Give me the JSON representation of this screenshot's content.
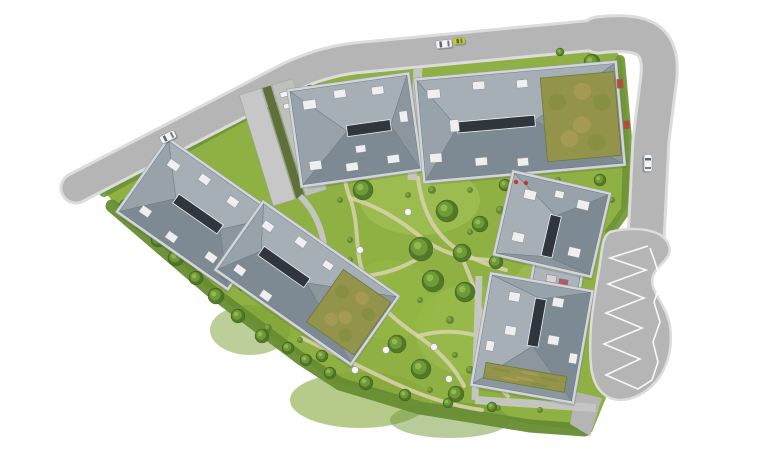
{
  "meta": {
    "label": "Aerial architectural site plan rendering of a residential complex with six buildings, gardens, perimeter roads and cars"
  },
  "palette": {
    "background": "#ffffff",
    "road": "#b5b5b5",
    "curb": "#dcdcdc",
    "marking": "#ffffff",
    "grass": "#8fb043",
    "grass_dark": "#6d9435",
    "grass_darker": "#678c31",
    "grass_light": "#a9c75a",
    "sand_path": "#d9d2ae",
    "gray_path": "#c6c6c6",
    "tree_dark": "#4e7527",
    "tree_mid": "#6f9a35",
    "tree_light": "#93b84f",
    "bush": "#5d8230",
    "bush_inner": "#7fa33e",
    "wall": "#d3d6d9",
    "wall_edge": "#969ca2",
    "roof_north": "#a7afb6",
    "roof_south": "#7e8a93",
    "roof_west": "#98a2aa",
    "roof_east": "#8b969f",
    "roof_edge": "#6e7a84",
    "ridge": "#2f363d",
    "ridge_frame": "#eeeeee",
    "skylight": "#efefef",
    "skylight_edge": "#8a9096",
    "green_roof": "#93934c",
    "green_roof_edge": "#6c7a36",
    "green_roof_dark": "#7d8c3c",
    "green_roof_tan": "#b3a05a",
    "car_white": "#f4f4f4",
    "car_yellow": "#c3d117",
    "car_edge": "#8d9298",
    "car_window": "#5a6470",
    "shadow": "#2a3a1a"
  },
  "roads": {
    "segments": [
      {
        "id": "road-northwest",
        "d": "M 76 188 L 290 77 Q 322 62 354 58 L 596 35",
        "width": 27
      },
      {
        "id": "road-east",
        "d": "M 598 35 Q 636 30 650 42 Q 661 52 659 76 L 651 140 L 646 240",
        "width": 33
      }
    ],
    "bulb_d": "M 610 232 C 632 226 664 228 669 246 C 673 259 657 264 653 276 C 648 290 666 303 670 326 C 674 355 663 384 637 396 C 612 407 594 394 591 366 C 588 332 594 298 599 270 C 602 252 602 236 610 232 Z",
    "exit_stub_points": "576,392 602,398 590,436 570,424",
    "zigzag_points": "648,246 610,258 646,270 608,284 644,298 606,313 642,328 604,344 640,359 606,375 638,389 652,380 658,362 653,342 660,322 654,302 661,282 655,262 650,248",
    "zigzag_width": 1.6
  },
  "site": {
    "boundary_points": "100,186 298,80 330,64 360,57 596,36 612,44 622,60 628,120 630,200 614,230 600,262 595,320 596,368 606,398 592,432 530,424 480,412 430,404 380,392 333,382 305,361 255,324 210,290 160,245 118,208",
    "belts": [
      {
        "d": "M 104 192 L 300 86 L 340 70",
        "w": 10,
        "color": "#6d9435",
        "o": 0.9
      },
      {
        "d": "M 340 70 L 595 44",
        "w": 9,
        "color": "#6d9435",
        "o": 0.9
      },
      {
        "d": "M 112 206 L 210 290 L 300 358 L 340 384 L 420 408 L 530 426 L 585 430",
        "w": 13,
        "color": "#678c31",
        "o": 0.95
      },
      {
        "d": "M 620 60 L 628 150 L 626 210 L 610 232",
        "w": 10,
        "color": "#6d9435",
        "o": 0.9
      }
    ],
    "patches": [
      {
        "cx": 420,
        "cy": 200,
        "rx": 60,
        "ry": 35,
        "fill": "#a9c75a",
        "o": 0.55
      },
      {
        "cx": 470,
        "cy": 330,
        "rx": 55,
        "ry": 45,
        "fill": "#9dbf4e",
        "o": 0.6
      },
      {
        "cx": 360,
        "cy": 400,
        "rx": 70,
        "ry": 28,
        "fill": "#85a93c",
        "o": 0.6
      },
      {
        "cx": 250,
        "cy": 330,
        "rx": 40,
        "ry": 25,
        "fill": "#7ba034",
        "o": 0.5
      },
      {
        "cx": 540,
        "cy": 300,
        "rx": 30,
        "ry": 40,
        "fill": "#a9c75a",
        "o": 0.45
      },
      {
        "cx": 390,
        "cy": 300,
        "rx": 45,
        "ry": 40,
        "fill": "#96b944",
        "o": 0.5
      },
      {
        "cx": 450,
        "cy": 420,
        "rx": 60,
        "ry": 18,
        "fill": "#6f9a35",
        "o": 0.5
      },
      {
        "cx": 580,
        "cy": 120,
        "rx": 28,
        "ry": 45,
        "fill": "#a2c050",
        "o": 0.5
      }
    ]
  },
  "garden": {
    "sand_paths": [
      "M 340 104 C 346 138 338 168 350 198 C 360 226 354 250 364 276 C 374 302 394 320 418 336 C 438 350 454 366 464 386",
      "M 418 178 C 422 210 434 234 458 250 C 474 260 490 266 506 270",
      "M 350 198 C 378 206 400 220 422 238 C 446 256 470 260 498 260",
      "M 364 276 C 392 274 414 262 432 250",
      "M 458 250 C 472 278 482 308 486 340 C 490 366 496 386 508 396",
      "M 302 338 C 332 352 362 368 392 382 C 422 396 452 406 482 410",
      "M 418 336 C 440 330 462 330 484 338"
    ],
    "gray_paths": [
      {
        "d": "M 418 68 L 412 180",
        "w": 9
      },
      {
        "d": "M 479 276 L 475 400",
        "w": 7
      },
      {
        "d": "M 475 400 L 596 408",
        "w": 8
      },
      {
        "d": "M 300 196 C 314 210 322 228 324 246",
        "w": 6
      }
    ],
    "trees": [
      [
        363,
        190,
        10
      ],
      [
        447,
        211,
        11
      ],
      [
        480,
        224,
        8
      ],
      [
        421,
        249,
        12
      ],
      [
        462,
        253,
        9
      ],
      [
        433,
        281,
        11
      ],
      [
        465,
        292,
        10
      ],
      [
        397,
        344,
        9
      ],
      [
        421,
        369,
        10
      ],
      [
        456,
        394,
        8
      ],
      [
        496,
        262,
        7
      ],
      [
        322,
        356,
        6
      ],
      [
        505,
        185,
        6
      ],
      [
        126,
        206,
        7
      ],
      [
        142,
        222,
        8
      ],
      [
        158,
        240,
        7
      ],
      [
        176,
        258,
        8
      ],
      [
        196,
        278,
        7
      ],
      [
        216,
        296,
        8
      ],
      [
        238,
        316,
        7
      ],
      [
        262,
        336,
        7
      ],
      [
        288,
        348,
        6
      ],
      [
        306,
        360,
        6
      ],
      [
        330,
        373,
        6
      ],
      [
        366,
        383,
        7
      ],
      [
        405,
        395,
        6
      ],
      [
        448,
        403,
        5
      ],
      [
        492,
        407,
        5
      ],
      [
        310,
        90,
        5
      ],
      [
        560,
        52,
        4
      ],
      [
        592,
        62,
        8
      ],
      [
        602,
        88,
        9
      ],
      [
        596,
        116,
        7
      ],
      [
        608,
        146,
        7
      ],
      [
        600,
        180,
        6
      ]
    ],
    "bushes": [
      [
        340,
        200,
        3
      ],
      [
        408,
        195,
        3
      ],
      [
        432,
        190,
        4
      ],
      [
        470,
        190,
        3
      ],
      [
        500,
        210,
        4
      ],
      [
        470,
        232,
        3
      ],
      [
        558,
        180,
        3
      ],
      [
        350,
        240,
        3
      ],
      [
        350,
        260,
        3
      ],
      [
        420,
        300,
        3
      ],
      [
        450,
        320,
        4
      ],
      [
        455,
        355,
        3
      ],
      [
        430,
        390,
        3
      ],
      [
        470,
        370,
        4
      ],
      [
        498,
        408,
        3
      ],
      [
        540,
        410,
        3
      ],
      [
        300,
        340,
        3
      ],
      [
        268,
        328,
        4
      ],
      [
        242,
        287,
        4
      ],
      [
        250,
        270,
        3
      ],
      [
        612,
        200,
        3
      ]
    ],
    "furniture": [
      [
        360,
        250
      ],
      [
        355,
        370
      ],
      [
        386,
        350
      ],
      [
        434,
        347
      ],
      [
        449,
        379
      ],
      [
        408,
        212
      ]
    ],
    "red_accents": [
      [
        516,
        182
      ],
      [
        526,
        183
      ]
    ]
  },
  "ramp": {
    "cx": 284,
    "cy": 142,
    "rot": -17,
    "length": 116,
    "lanes": [
      {
        "dx": -29,
        "w": 23,
        "fill": "#c7c7c7"
      },
      {
        "dx": -5,
        "w": 9,
        "fill": "#5f7038"
      },
      {
        "dx": 5,
        "w": 22,
        "fill": "#bdc1ba"
      }
    ],
    "parked": [
      [
        10,
        -48,
        9,
        5
      ],
      [
        10,
        -36,
        9,
        5
      ]
    ]
  },
  "buildings": [
    {
      "id": "annex-west-link",
      "type": "flat",
      "cx": 252,
      "cy": 247,
      "w": 30,
      "h": 20,
      "rot": 35,
      "fill": "#b9bfc4",
      "accents": []
    },
    {
      "id": "annex-east-link",
      "type": "flat",
      "cx": 556,
      "cy": 281,
      "w": 46,
      "h": 24,
      "rot": 10,
      "fill": "#aeb4ba",
      "accents": [
        [
          -10,
          -5,
          10,
          7,
          "#d8d3d6"
        ],
        [
          3,
          -3,
          9,
          6,
          "#b05a6a"
        ]
      ]
    },
    {
      "id": "building-west-upper",
      "type": "hip",
      "cx": 198,
      "cy": 214,
      "w": 132,
      "h": 86,
      "rot": 35,
      "orient": "h",
      "ridge_len": 54,
      "ridge_dx": 0,
      "ridge_dy": 0,
      "skylights": [
        [
          -54,
          -30,
          12,
          8
        ],
        [
          -20,
          -36,
          11,
          8
        ],
        [
          16,
          -34,
          11,
          8
        ],
        [
          -50,
          24,
          11,
          8
        ],
        [
          -14,
          30,
          11,
          8
        ],
        [
          30,
          24,
          11,
          8
        ],
        [
          52,
          -6,
          7,
          10
        ]
      ]
    },
    {
      "id": "building-west-lower",
      "type": "hip",
      "cx": 307,
      "cy": 283,
      "w": 162,
      "h": 80,
      "rot": 35,
      "orient": "h",
      "ridge_len": 56,
      "ridge_dx": -28,
      "ridge_dy": 0,
      "green_roof": [
        22,
        -32,
        58,
        64
      ],
      "skylights": [
        [
          -70,
          -28,
          11,
          8
        ],
        [
          -34,
          -34,
          11,
          8
        ],
        [
          -68,
          24,
          11,
          8
        ],
        [
          -32,
          30,
          11,
          8
        ],
        [
          2,
          -30,
          10,
          7
        ]
      ]
    },
    {
      "id": "building-north-west",
      "type": "hip",
      "cx": 355,
      "cy": 130,
      "w": 118,
      "h": 94,
      "rot": -8,
      "orient": "h",
      "ridge_len": 44,
      "ridge_dx": 14,
      "ridge_dy": 0,
      "skylights": [
        [
          -48,
          -36,
          13,
          9
        ],
        [
          -16,
          -42,
          12,
          8
        ],
        [
          22,
          -40,
          12,
          8
        ],
        [
          -50,
          25,
          12,
          9
        ],
        [
          -14,
          32,
          12,
          8
        ],
        [
          28,
          30,
          12,
          8
        ],
        [
          46,
          -12,
          8,
          11
        ],
        [
          -2,
          16,
          10,
          7
        ]
      ]
    },
    {
      "id": "building-north-east",
      "type": "hip",
      "cx": 520,
      "cy": 122,
      "w": 198,
      "h": 100,
      "rot": -5,
      "orient": "h",
      "ridge_len": 78,
      "ridge_dx": -24,
      "ridge_dy": 0,
      "green_roof": [
        24,
        -42,
        74,
        84
      ],
      "skylights": [
        [
          -90,
          -40,
          13,
          9
        ],
        [
          -93,
          24,
          12,
          9
        ],
        [
          -44,
          -44,
          12,
          8
        ],
        [
          -48,
          32,
          12,
          8
        ],
        [
          0,
          -42,
          11,
          8
        ],
        [
          -6,
          36,
          11,
          8
        ],
        [
          -70,
          -8,
          9,
          12
        ]
      ],
      "accents": [
        [
          100,
          -34,
          6,
          9,
          "#b84a3a"
        ],
        [
          103,
          8,
          6,
          8,
          "#b84a3a"
        ]
      ]
    },
    {
      "id": "building-east-upper",
      "type": "hip",
      "cx": 552,
      "cy": 224,
      "w": 96,
      "h": 82,
      "rot": 13,
      "orient": "v",
      "ridge_len": 42,
      "ridge_dx": 2,
      "ridge_dy": 12,
      "skylights": [
        [
          -34,
          -28,
          12,
          9
        ],
        [
          20,
          -30,
          12,
          9
        ],
        [
          -36,
          16,
          12,
          9
        ],
        [
          22,
          18,
          12,
          9
        ],
        [
          -4,
          -34,
          9,
          7
        ]
      ]
    },
    {
      "id": "building-east-lower",
      "type": "hip",
      "cx": 532,
      "cy": 338,
      "w": 100,
      "h": 110,
      "rot": 10,
      "orient": "v",
      "ridge_len": 48,
      "ridge_dx": 2,
      "ridge_dy": -16,
      "green_roof": [
        -41,
        32,
        82,
        16
      ],
      "skylights": [
        [
          -30,
          -42,
          11,
          9
        ],
        [
          14,
          -44,
          11,
          9
        ],
        [
          -28,
          -8,
          11,
          9
        ],
        [
          16,
          -6,
          11,
          9
        ],
        [
          -44,
          10,
          8,
          10
        ],
        [
          40,
          8,
          8,
          10
        ]
      ]
    }
  ],
  "cars": [
    {
      "id": "car-northwest-road",
      "x": 168,
      "y": 137,
      "rot": -27,
      "color": "#f4f4f4",
      "len": 16,
      "wid": 8
    },
    {
      "id": "car-north-road-white",
      "x": 444,
      "y": 44,
      "rot": -6,
      "color": "#f2f2f2",
      "len": 16,
      "wid": 8
    },
    {
      "id": "car-north-road-yellow",
      "x": 459,
      "y": 41,
      "rot": -6,
      "color": "#c3d117",
      "len": 12,
      "wid": 6.5
    },
    {
      "id": "car-east-road",
      "x": 648,
      "y": 163,
      "rot": 90,
      "color": "#f4f4f4",
      "len": 17,
      "wid": 8
    }
  ]
}
